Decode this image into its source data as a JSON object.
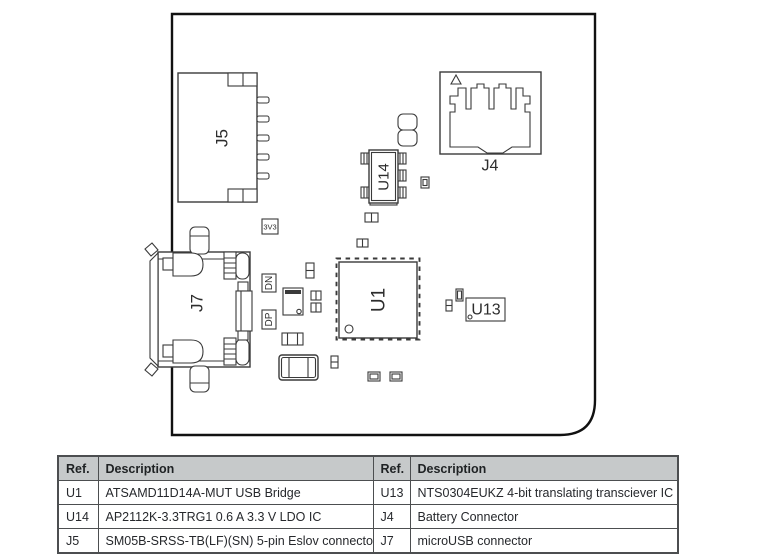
{
  "diagram": {
    "refs": {
      "j5": "J5",
      "j7": "J7",
      "j4": "J4",
      "u1": "U1",
      "u13": "U13",
      "u14": "U14"
    },
    "nets": {
      "v33": "3V3",
      "dn": "DN",
      "dp": "DP"
    }
  },
  "table": {
    "headers": [
      "Ref.",
      "Description",
      "Ref.",
      "Description"
    ],
    "rows": [
      [
        "U1",
        "ATSAMD11D14A-MUT USB Bridge",
        "U13",
        "NTS0304EUKZ 4-bit translating transciever IC"
      ],
      [
        "U14",
        "AP2112K-3.3TRG1 0.6 A 3.3 V LDO IC",
        "J4",
        "Battery Connector"
      ],
      [
        "J5",
        "SM05B-SRSS-TB(LF)(SN) 5-pin Eslov connector",
        "J7",
        "microUSB connector"
      ]
    ]
  },
  "colors": {
    "line_art": "#3a3a3a",
    "board_outline": "#111111",
    "table_header_bg": "#c6c9ca",
    "table_border": "#4c4e50",
    "text": "#26282c"
  }
}
